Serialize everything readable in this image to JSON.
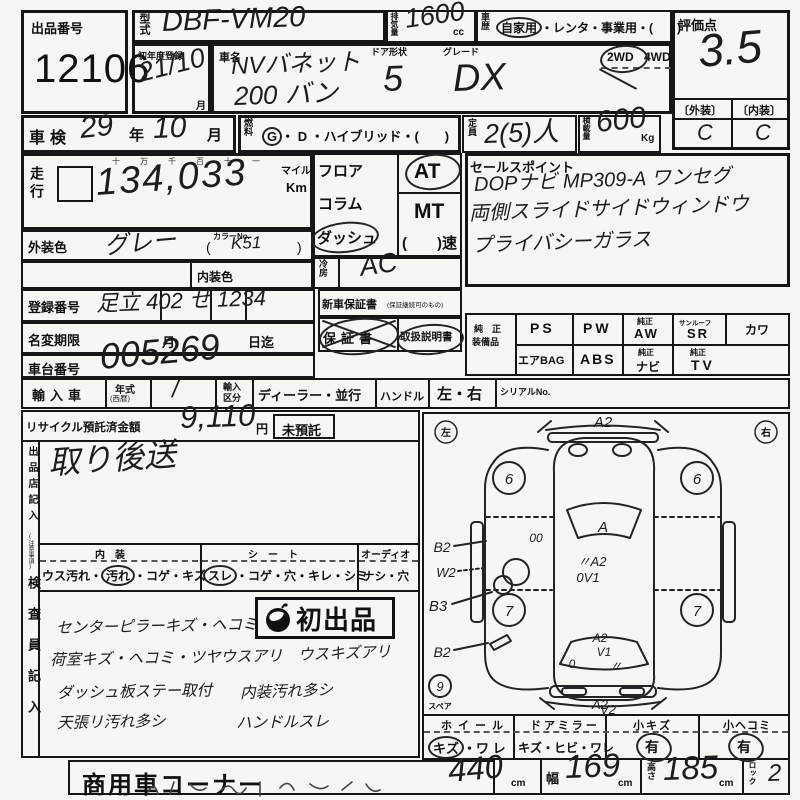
{
  "colors": {
    "paper": "#f6f6f2",
    "ink": "#161616",
    "handwriting": "#1d1d1d"
  },
  "sheet": {
    "lot": {
      "label": "出品番号",
      "number": "12106"
    },
    "model": {
      "label": "型式",
      "value": "DBF-VM20"
    },
    "displacement": {
      "label": "排気量",
      "value": "1600",
      "unit": "cc"
    },
    "history": {
      "label": "車歴",
      "selected": "自家用",
      "rest": "・レンタ・事業用・(　　)"
    },
    "score": {
      "label": "評価点",
      "value": "3.5",
      "exterior_label": "〔外装〕",
      "interior_label": "〔内装〕",
      "exterior": "C",
      "interior": "C"
    },
    "first_reg": {
      "label": "初年度登録",
      "value": "21/10",
      "suffix": "月"
    },
    "name": {
      "label": "車名",
      "line1": "NVバネット",
      "line2": "200 バン",
      "door_label": "ドア形状",
      "door": "5",
      "grade_label": "グレード",
      "grade": "DX",
      "drive_2wd": "2WD",
      "drive_4wd": "4WD"
    },
    "shaken": {
      "label": "車検",
      "year": "29",
      "year_suffix": "年",
      "month": "10",
      "month_suffix": "月"
    },
    "fuel": {
      "label": "燃料",
      "selected": "G",
      "rest": "・ D ・ハイブリッド・(　　)"
    },
    "capacity": {
      "label": "定員",
      "value": "2(5)人"
    },
    "load": {
      "label": "積載量",
      "value": "600",
      "unit": "Kg"
    },
    "mileage": {
      "label": "走行",
      "digit_guide": "十万千百十一",
      "value": "134,033",
      "unit_mile": "マイル",
      "unit_km": "Km"
    },
    "shift": {
      "floor": "フロア",
      "column": "コラム",
      "dash": "ダッシュ",
      "at": "AT",
      "mt": "MT",
      "speed": "(　　)速"
    },
    "ac": {
      "label": "冷房",
      "value": "AC"
    },
    "ext_color": {
      "label": "外装色",
      "value": "グレー",
      "color_no_label": "カラーNo.",
      "open": "(",
      "color_no": "K51",
      "close": ")"
    },
    "int_color": {
      "label": "内装色"
    },
    "reg_no": {
      "label": "登録番号",
      "value": "足立 402 せ 1234"
    },
    "warranty": {
      "label": "新車保証書",
      "note": "(保証継続可のもの)",
      "book": "保証書",
      "manual": "取扱説明書"
    },
    "name_change": {
      "label": "名変期限",
      "month": "月",
      "day": "日迄"
    },
    "chassis": {
      "label": "車台番号",
      "value": "005269"
    },
    "sales_point": {
      "label": "セールスポイント",
      "line1": "DOPナビ MP309-A ワンセグ",
      "line2": "両側スライドサイドウィンドウ",
      "line3": "プライバシーガラス"
    },
    "equipment": {
      "label1": "純　正",
      "label2": "装備品",
      "ps": "PS",
      "pw": "PW",
      "aw_s": "純正",
      "aw": "AW",
      "sr_s": "サンルーフ",
      "sr": "SR",
      "leather": "カワ",
      "airbag": "エアBAG",
      "abs": "ABS",
      "navi_s": "純正",
      "navi": "ナビ",
      "tv_s": "純正",
      "tv": "TV"
    },
    "import": {
      "label": "輸入車",
      "year_label": "年式",
      "year_small": "(西暦)",
      "year_value": "/",
      "div1": "輸入",
      "div2": "区分",
      "division": "ディーラー・並行",
      "handle_label": "ハンドル",
      "handle": "左・右",
      "serial": "シリアルNo."
    },
    "recycle": {
      "label": "リサイクル預託済金額",
      "amount": "9,110",
      "yen": "円",
      "not_deposited": "未預託"
    },
    "seller": {
      "label": "出品店記入",
      "label_small": "(注意事項)",
      "note": "取り後送"
    },
    "interior_check": {
      "header": "内　装",
      "pre": "ウス汚れ・",
      "circled": "汚れ",
      "post": "・コゲ・キズ"
    },
    "seat_check": {
      "header": "シ　ー　ト",
      "circled": "スレ",
      "post": "・コゲ・穴・キレ・シミ"
    },
    "audio_check": {
      "header": "オーディオ",
      "options": "ナシ・穴"
    },
    "inspector": {
      "label": "検査員記入",
      "stamp": "初出品",
      "note1": "センターピラーキズ・ヘコミ",
      "note2": "荷室キズ・ヘコミ・ツヤウスアリ",
      "note2b": "ウスキズアリ",
      "note3": "ダッシュ板ステー取付",
      "note3b": "内装汚れ多シ",
      "note4": "天張リ汚れ多シ",
      "note4b": "ハンドルスレ"
    },
    "diagram": {
      "left": "左",
      "right": "右",
      "front": "A2",
      "door_00": "00",
      "windshield": "A",
      "center_a2": "〃A2",
      "center_0v1": "0V1",
      "b2_upper": "B2",
      "w2": "W2",
      "b3": "B3",
      "b2_lower": "B2",
      "wheel_fl": "6",
      "wheel_fr": "6",
      "wheel_rl": "7",
      "wheel_rr": "7",
      "rear_a2": "A2",
      "rear_v1": "V1",
      "rear_0": "0",
      "rear_tick": "〃",
      "spare_no": "9",
      "spare_label": "スペア",
      "bottom_a2": "A2",
      "bottom_v2": "V2"
    },
    "wheel_check": {
      "header": "ホイール",
      "circled": "キズ",
      "post": "・ワ レ"
    },
    "mirror_check": {
      "header": "ドアミラー",
      "options": "キズ・ヒビ・ワレ"
    },
    "small_scratch": {
      "header": "小キズ",
      "value": "有"
    },
    "small_dent": {
      "header": "小ヘコミ",
      "value": "有"
    },
    "size": {
      "length_label": "長さ",
      "length": "440",
      "width_label": "幅",
      "width": "169",
      "height_label": "高さ",
      "height": "185",
      "unit": "cm",
      "lock_label": "ロック",
      "lock": "2"
    },
    "footer": {
      "corner": "商用車コーナー"
    }
  }
}
